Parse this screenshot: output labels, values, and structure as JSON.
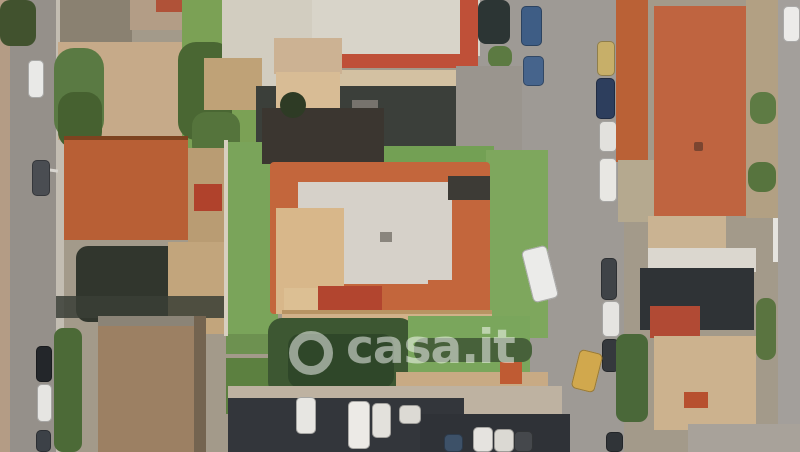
{
  "watermark": {
    "text": "casa.it",
    "color": "rgba(255,255,255,0.5)"
  },
  "scene": {
    "description": "aerial-satellite-view-residential-block",
    "background": "#a39a8a",
    "palette": {
      "road": "#9e9a95",
      "lawn": "#7aa45a",
      "terracotta": "#b85f35",
      "villa_border_tile": "#c3663c",
      "villa_flat_roof": "#d6d1c9",
      "shadow": "#33363b",
      "dirt": "#b99c73"
    },
    "elements": [
      {
        "n": "base-terrain",
        "x": 0,
        "y": 0,
        "w": 800,
        "h": 452,
        "c": "#a39a8a"
      },
      {
        "n": "left-road",
        "x": 4,
        "y": 0,
        "w": 52,
        "h": 452,
        "c": "#95908a"
      },
      {
        "n": "left-road-sidewalk",
        "x": 56,
        "y": 0,
        "w": 8,
        "h": 452,
        "c": "#c3bdb2"
      },
      {
        "n": "left-edge-facades",
        "x": 0,
        "y": 0,
        "w": 10,
        "h": 452,
        "c": "#b49c85"
      },
      {
        "n": "right-road-upper",
        "x": 460,
        "y": 0,
        "w": 164,
        "h": 102,
        "c": "#9e9a95"
      },
      {
        "n": "right-road",
        "x": 518,
        "y": 0,
        "w": 106,
        "h": 452,
        "c": "#9e9a95"
      },
      {
        "n": "right-edge-road",
        "x": 778,
        "y": 0,
        "w": 22,
        "h": 452,
        "c": "#a39f9b"
      },
      {
        "n": "right-edge-wall",
        "x": 773,
        "y": 0,
        "w": 5,
        "h": 262,
        "c": "#e6e4df"
      },
      {
        "n": "top-left-trees",
        "x": 0,
        "y": 0,
        "w": 36,
        "h": 46,
        "c": "#41522e",
        "r": 10,
        "cls": "leafy"
      },
      {
        "n": "top-left-roof-dark",
        "x": 60,
        "y": 0,
        "w": 72,
        "h": 42,
        "c": "#8a8171",
        "cls": "corrugated"
      },
      {
        "n": "top-left-roof-tan",
        "x": 130,
        "y": 0,
        "w": 60,
        "h": 30,
        "c": "#b39d86"
      },
      {
        "n": "top-left-roof-red",
        "x": 156,
        "y": 0,
        "w": 32,
        "h": 12,
        "c": "#b05238"
      },
      {
        "n": "top-left-yard",
        "x": 58,
        "y": 42,
        "w": 132,
        "h": 98,
        "c": "#c6aa89"
      },
      {
        "n": "roadside-trees",
        "x": 54,
        "y": 48,
        "w": 50,
        "h": 92,
        "c": "#5a7a43",
        "r": 20,
        "cls": "leafy"
      },
      {
        "n": "roadside-trees-dark",
        "x": 58,
        "y": 92,
        "w": 44,
        "h": 56,
        "c": "#466130",
        "r": 16,
        "cls": "leafy"
      },
      {
        "n": "north-garden",
        "x": 182,
        "y": 0,
        "w": 92,
        "h": 148,
        "c": "#7ba155"
      },
      {
        "n": "north-garden-trees",
        "x": 178,
        "y": 42,
        "w": 54,
        "h": 98,
        "c": "#4a6733",
        "r": 18,
        "cls": "leafy"
      },
      {
        "n": "north-garden-trees-2",
        "x": 192,
        "y": 112,
        "w": 48,
        "h": 48,
        "c": "#55743c",
        "r": 14,
        "cls": "leafy"
      },
      {
        "n": "warehouse-west",
        "x": 222,
        "y": 0,
        "w": 92,
        "h": 92,
        "c": "#d2cdc0",
        "cls": "corrugated"
      },
      {
        "n": "warehouse-main",
        "x": 312,
        "y": 0,
        "w": 168,
        "h": 56,
        "c": "#d8d4c9",
        "cls": "corrugated"
      },
      {
        "n": "warehouse-red-tile-h",
        "x": 338,
        "y": 54,
        "w": 140,
        "h": 14,
        "c": "#bf5038"
      },
      {
        "n": "warehouse-red-tile-v",
        "x": 460,
        "y": 0,
        "w": 18,
        "h": 66,
        "c": "#bf5038"
      },
      {
        "n": "warehouse-annex",
        "x": 336,
        "y": 70,
        "w": 134,
        "h": 20,
        "c": "#d3c1a2"
      },
      {
        "n": "dark-trees-ne",
        "x": 478,
        "y": 0,
        "w": 32,
        "h": 44,
        "c": "#2c3534",
        "r": 8
      },
      {
        "n": "bush-ne",
        "x": 488,
        "y": 46,
        "w": 24,
        "h": 22,
        "c": "#5c7a42",
        "r": 9,
        "cls": "leafy"
      },
      {
        "n": "courtyard-tan",
        "x": 204,
        "y": 58,
        "w": 58,
        "h": 52,
        "c": "#bfa277"
      },
      {
        "n": "courtyard-shadow",
        "x": 256,
        "y": 86,
        "w": 212,
        "h": 64,
        "c": "#3b3f3a"
      },
      {
        "n": "courtyard-object-1",
        "x": 300,
        "y": 94,
        "w": 30,
        "h": 18,
        "c": "#8e8a84"
      },
      {
        "n": "courtyard-object-2",
        "x": 352,
        "y": 100,
        "w": 26,
        "h": 13,
        "c": "#77736d"
      },
      {
        "n": "driveway",
        "x": 456,
        "y": 66,
        "w": 66,
        "h": 92,
        "c": "#9a958e"
      },
      {
        "n": "dirt-yard",
        "x": 188,
        "y": 148,
        "w": 40,
        "h": 168,
        "c": "#b99c73"
      },
      {
        "n": "garden-shed-red",
        "x": 194,
        "y": 184,
        "w": 28,
        "h": 27,
        "c": "#b0422c"
      },
      {
        "n": "house-roof-shadow-edge",
        "x": 64,
        "y": 136,
        "w": 124,
        "h": 8,
        "c": "#7e431f"
      },
      {
        "n": "house-terracotta-roof",
        "x": 64,
        "y": 140,
        "w": 124,
        "h": 100,
        "c": "#b85f35",
        "cls": "ridge-v"
      },
      {
        "n": "house-shadow",
        "x": 76,
        "y": 246,
        "w": 106,
        "h": 76,
        "c": "#31362d",
        "r": 12
      },
      {
        "n": "courtyard-south",
        "x": 168,
        "y": 242,
        "w": 60,
        "h": 92,
        "c": "#c2a57c"
      },
      {
        "n": "mid-garden-1",
        "x": 226,
        "y": 296,
        "w": 44,
        "h": 58,
        "c": "#6d9150",
        "cls": "leafy"
      },
      {
        "n": "mid-garden-2",
        "x": 226,
        "y": 358,
        "w": 44,
        "h": 56,
        "c": "#5c8040",
        "cls": "leafy"
      },
      {
        "n": "shadow-band-sw",
        "x": 56,
        "y": 296,
        "w": 174,
        "h": 22,
        "c": "#3a3e36",
        "o": 0.85
      },
      {
        "n": "southwest-building",
        "x": 98,
        "y": 316,
        "w": 98,
        "h": 136,
        "c": "#9c8063",
        "cls": "corrugated"
      },
      {
        "n": "southwest-building-ridge",
        "x": 98,
        "y": 316,
        "w": 98,
        "h": 10,
        "c": "#8b8477"
      },
      {
        "n": "southwest-building-wall",
        "x": 194,
        "y": 316,
        "w": 12,
        "h": 136,
        "c": "#746450"
      },
      {
        "n": "hedge-sw",
        "x": 54,
        "y": 328,
        "w": 28,
        "h": 124,
        "c": "#4c6a37",
        "r": 9,
        "cls": "leafy"
      },
      {
        "n": "street-lamp-arm",
        "x": 34,
        "y": 168,
        "w": 24,
        "h": 3,
        "c": "#d8d5cf",
        "rot": 8
      },
      {
        "n": "car-white-nw",
        "x": 28,
        "y": 60,
        "w": 16,
        "h": 38,
        "c": "#e9e9e7",
        "cls": "car"
      },
      {
        "n": "car-gray-w",
        "x": 32,
        "y": 160,
        "w": 18,
        "h": 36,
        "c": "#4a4d52",
        "cls": "car"
      },
      {
        "n": "car-black-sw",
        "x": 36,
        "y": 346,
        "w": 16,
        "h": 36,
        "c": "#23262a",
        "cls": "car"
      },
      {
        "n": "car-white-sw",
        "x": 37,
        "y": 384,
        "w": 15,
        "h": 38,
        "c": "#e6e5e2",
        "cls": "car"
      },
      {
        "n": "car-dark-sw",
        "x": 36,
        "y": 430,
        "w": 15,
        "h": 22,
        "c": "#3c4147",
        "cls": "car"
      },
      {
        "n": "villa-lawn-west",
        "x": 226,
        "y": 142,
        "w": 52,
        "h": 192,
        "c": "#7aa45a"
      },
      {
        "n": "villa-wall-west",
        "x": 224,
        "y": 140,
        "w": 4,
        "h": 196,
        "c": "#d8cfc0"
      },
      {
        "n": "villa-lawn-north",
        "x": 340,
        "y": 146,
        "w": 154,
        "h": 18,
        "c": "#73a054"
      },
      {
        "n": "villa-lawn-east",
        "x": 486,
        "y": 150,
        "w": 62,
        "h": 188,
        "c": "#7ea75d"
      },
      {
        "n": "villa-north-building",
        "x": 274,
        "y": 38,
        "w": 68,
        "h": 36,
        "c": "#ccb293"
      },
      {
        "n": "villa-north-terrace",
        "x": 276,
        "y": 72,
        "w": 64,
        "h": 36,
        "c": "#d8bc95"
      },
      {
        "n": "villa-north-dark-roof",
        "x": 262,
        "y": 108,
        "w": 122,
        "h": 56,
        "c": "#3b3630"
      },
      {
        "n": "villa-round-tree",
        "x": 280,
        "y": 92,
        "w": 26,
        "h": 26,
        "c": "#2e3b25",
        "r": "50%"
      },
      {
        "n": "villa-tile-border",
        "x": 270,
        "y": 162,
        "w": 220,
        "h": 152,
        "c": "#c3663c",
        "r": 4
      },
      {
        "n": "villa-flat-roof",
        "x": 298,
        "y": 182,
        "w": 154,
        "h": 102,
        "c": "#d6d1c9"
      },
      {
        "n": "villa-terrace-west",
        "x": 276,
        "y": 208,
        "w": 68,
        "h": 106,
        "c": "#d8b78a"
      },
      {
        "n": "villa-terrace-sw",
        "x": 284,
        "y": 288,
        "w": 76,
        "h": 28,
        "c": "#dcbf93"
      },
      {
        "n": "villa-awning",
        "x": 318,
        "y": 286,
        "w": 64,
        "h": 28,
        "c": "#b2452f",
        "cls": "stripes"
      },
      {
        "n": "villa-wing-se",
        "x": 428,
        "y": 280,
        "w": 60,
        "h": 32,
        "c": "#c3663c"
      },
      {
        "n": "villa-dark-roof-ne",
        "x": 448,
        "y": 176,
        "w": 42,
        "h": 24,
        "c": "#3d3b36"
      },
      {
        "n": "villa-roof-object",
        "x": 380,
        "y": 232,
        "w": 12,
        "h": 10,
        "c": "#8a857d"
      },
      {
        "n": "villa-south-terrace",
        "x": 282,
        "y": 310,
        "w": 210,
        "h": 26,
        "c": "#d1b189"
      },
      {
        "n": "villa-terrace-railing",
        "x": 282,
        "y": 310,
        "w": 210,
        "h": 4,
        "c": "#b89463"
      },
      {
        "n": "south-garden-trees",
        "x": 268,
        "y": 318,
        "w": 146,
        "h": 78,
        "c": "#3d5732",
        "r": 14,
        "cls": "leafy"
      },
      {
        "n": "south-garden-trees-dark",
        "x": 288,
        "y": 334,
        "w": 106,
        "h": 54,
        "c": "#2f4729",
        "r": 12,
        "cls": "leafy"
      },
      {
        "n": "south-lawn",
        "x": 408,
        "y": 316,
        "w": 122,
        "h": 74,
        "c": "#7aa65c"
      },
      {
        "n": "south-hedge",
        "x": 414,
        "y": 338,
        "w": 118,
        "h": 24,
        "c": "#47613a",
        "r": 10,
        "cls": "leafy"
      },
      {
        "n": "boundary-wall",
        "x": 396,
        "y": 372,
        "w": 152,
        "h": 20,
        "c": "#c8aa84"
      },
      {
        "n": "orange-kiosk",
        "x": 500,
        "y": 362,
        "w": 22,
        "h": 22,
        "c": "#bf5b33"
      },
      {
        "n": "parking-lot",
        "x": 228,
        "y": 386,
        "w": 334,
        "h": 66,
        "c": "#beb2a1"
      },
      {
        "n": "parking-shadow",
        "x": 228,
        "y": 398,
        "w": 236,
        "h": 54,
        "c": "#33363b"
      },
      {
        "n": "parking-shadow-2",
        "x": 420,
        "y": 414,
        "w": 150,
        "h": 38,
        "c": "#2f3237"
      },
      {
        "n": "parked-car-1",
        "x": 296,
        "y": 397,
        "w": 20,
        "h": 37,
        "c": "#e7e6e2",
        "cls": "car"
      },
      {
        "n": "parked-car-2",
        "x": 348,
        "y": 401,
        "w": 22,
        "h": 48,
        "c": "#eceae6",
        "cls": "car"
      },
      {
        "n": "parked-car-3",
        "x": 372,
        "y": 403,
        "w": 19,
        "h": 35,
        "c": "#e3e1dc",
        "cls": "car"
      },
      {
        "n": "parked-van",
        "x": 399,
        "y": 405,
        "w": 22,
        "h": 19,
        "c": "#dcdad4",
        "cls": "car"
      },
      {
        "n": "parked-car-4",
        "x": 444,
        "y": 434,
        "w": 19,
        "h": 18,
        "c": "#3d5168",
        "cls": "car"
      },
      {
        "n": "parked-car-5",
        "x": 473,
        "y": 427,
        "w": 20,
        "h": 25,
        "c": "#e5e3df",
        "cls": "car"
      },
      {
        "n": "parked-car-6",
        "x": 494,
        "y": 429,
        "w": 20,
        "h": 23,
        "c": "#dbd9d3",
        "cls": "car"
      },
      {
        "n": "parked-car-7",
        "x": 514,
        "y": 431,
        "w": 19,
        "h": 21,
        "c": "#45484c",
        "cls": "car"
      },
      {
        "n": "car-blue-1",
        "x": 521,
        "y": 6,
        "w": 21,
        "h": 40,
        "c": "#3e5d85",
        "cls": "car"
      },
      {
        "n": "car-blue-2",
        "x": 523,
        "y": 56,
        "w": 21,
        "h": 30,
        "c": "#46648c",
        "cls": "car"
      },
      {
        "n": "car-yellow-n",
        "x": 597,
        "y": 41,
        "w": 18,
        "h": 35,
        "c": "#c7af69",
        "cls": "car"
      },
      {
        "n": "car-navy",
        "x": 596,
        "y": 78,
        "w": 19,
        "h": 41,
        "c": "#2d3e5d",
        "cls": "car"
      },
      {
        "n": "car-white-r1",
        "x": 599,
        "y": 121,
        "w": 18,
        "h": 31,
        "c": "#e2e1dd",
        "cls": "car"
      },
      {
        "n": "car-white-r2",
        "x": 599,
        "y": 158,
        "w": 18,
        "h": 44,
        "c": "#e8e7e3",
        "cls": "car"
      },
      {
        "n": "car-white-angled",
        "x": 527,
        "y": 247,
        "w": 26,
        "h": 54,
        "c": "#ebebe9",
        "cls": "car",
        "rot": -14
      },
      {
        "n": "car-dark-r1",
        "x": 601,
        "y": 258,
        "w": 16,
        "h": 42,
        "c": "#3f4347",
        "cls": "car"
      },
      {
        "n": "car-white-r3",
        "x": 602,
        "y": 301,
        "w": 18,
        "h": 36,
        "c": "#e5e4e1",
        "cls": "car"
      },
      {
        "n": "car-dark-r2",
        "x": 602,
        "y": 339,
        "w": 17,
        "h": 33,
        "c": "#35393d",
        "cls": "car"
      },
      {
        "n": "car-yellow-angled",
        "x": 575,
        "y": 351,
        "w": 24,
        "h": 40,
        "c": "#d1a84d",
        "cls": "car",
        "rot": 14
      },
      {
        "n": "car-dark-r3",
        "x": 606,
        "y": 432,
        "w": 17,
        "h": 20,
        "c": "#303438",
        "cls": "car"
      },
      {
        "n": "hedge-east",
        "x": 616,
        "y": 334,
        "w": 32,
        "h": 88,
        "c": "#4a6839",
        "r": 9,
        "cls": "leafy"
      },
      {
        "n": "car-white-ne",
        "x": 783,
        "y": 6,
        "w": 17,
        "h": 36,
        "c": "#ecebe9",
        "cls": "car"
      },
      {
        "n": "narrow-roof-strip",
        "x": 616,
        "y": 0,
        "w": 32,
        "h": 162,
        "c": "#ba6136",
        "cls": "ridge-v"
      },
      {
        "n": "sidewalk-east-mid",
        "x": 618,
        "y": 160,
        "w": 38,
        "h": 62,
        "c": "#b5a98f"
      },
      {
        "n": "orange-hip-roof",
        "x": 654,
        "y": 6,
        "w": 98,
        "h": 210,
        "c": "#bf6440",
        "cls": "hip"
      },
      {
        "n": "chimney",
        "x": 694,
        "y": 142,
        "w": 9,
        "h": 9,
        "c": "#7b4530",
        "r": 2
      },
      {
        "n": "east-scrub",
        "x": 746,
        "y": 0,
        "w": 32,
        "h": 218,
        "c": "#b2a083"
      },
      {
        "n": "east-bush-1",
        "x": 750,
        "y": 92,
        "w": 26,
        "h": 32,
        "c": "#5e7b44",
        "r": 11,
        "cls": "leafy"
      },
      {
        "n": "east-bush-2",
        "x": 748,
        "y": 162,
        "w": 28,
        "h": 30,
        "c": "#57743e",
        "r": 11,
        "cls": "leafy"
      },
      {
        "n": "east-tan-building",
        "x": 648,
        "y": 216,
        "w": 78,
        "h": 32,
        "c": "#cab392"
      },
      {
        "n": "east-white-strip",
        "x": 648,
        "y": 248,
        "w": 108,
        "h": 24,
        "c": "#dbd7cf"
      },
      {
        "n": "east-dark-roofs",
        "x": 640,
        "y": 268,
        "w": 114,
        "h": 62,
        "c": "#2f3336"
      },
      {
        "n": "east-red-roof",
        "x": 650,
        "y": 306,
        "w": 50,
        "h": 32,
        "c": "#b14a34"
      },
      {
        "n": "east-terrace",
        "x": 654,
        "y": 336,
        "w": 102,
        "h": 94,
        "c": "#ccb28e"
      },
      {
        "n": "east-red-shed",
        "x": 684,
        "y": 392,
        "w": 24,
        "h": 16,
        "c": "#b7502f"
      },
      {
        "n": "east-bush-3",
        "x": 756,
        "y": 298,
        "w": 20,
        "h": 62,
        "c": "#5a7440",
        "r": 9,
        "cls": "leafy"
      },
      {
        "n": "bottom-right-concrete",
        "x": 688,
        "y": 424,
        "w": 112,
        "h": 28,
        "c": "#a8a29a"
      }
    ]
  }
}
